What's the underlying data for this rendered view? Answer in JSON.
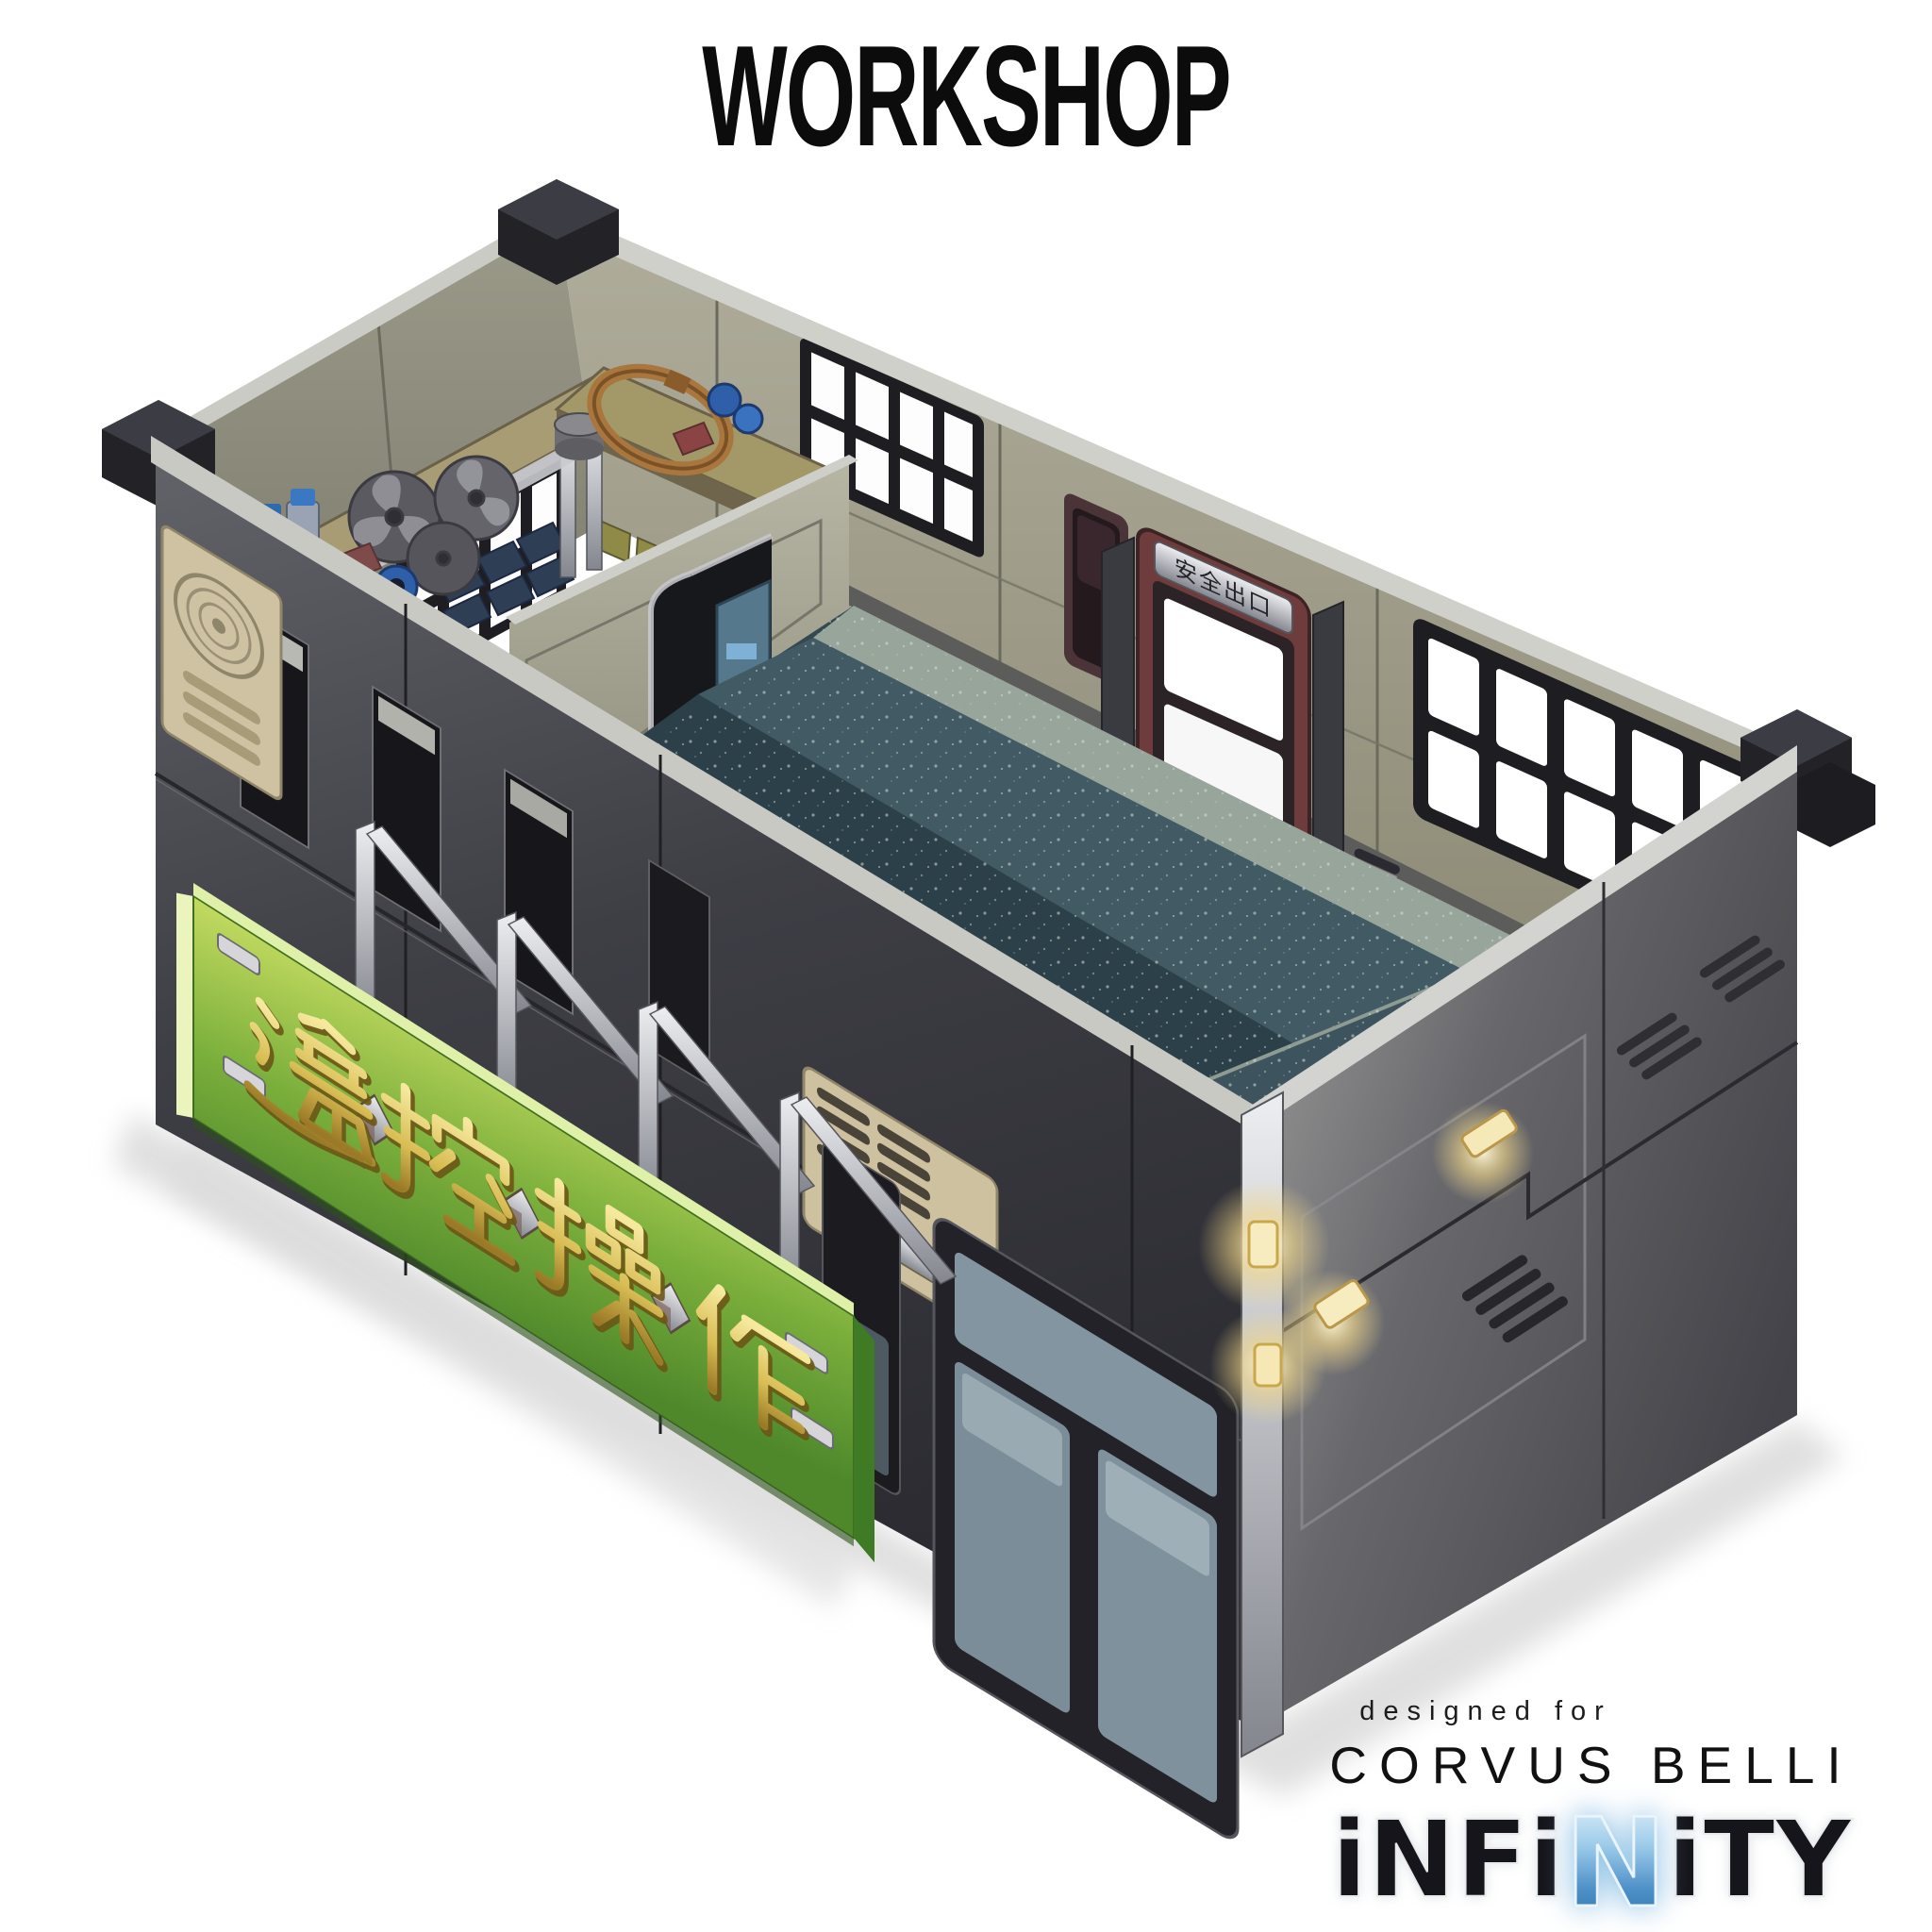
{
  "title": "WORKSHOP",
  "banner": {
    "text": "遥控操作",
    "characters": [
      "遥",
      "控",
      "操",
      "作"
    ],
    "panel_color": "#7fb23f",
    "character_color": "#d9bd55"
  },
  "building": {
    "exit_sign": "安全出口"
  },
  "footer": {
    "designed_for": "designed for",
    "brand": "CORVUS BELLI",
    "logo": {
      "part1": "iNFi",
      "accent": "N",
      "part2": "iTY"
    }
  },
  "colors": {
    "background": "#ffffff",
    "title_black": "#0c0c0c",
    "wall_dark": "#3b3b41",
    "wall_olive": "#8d8b7b",
    "floor_teal": "#3a525c",
    "sign_green": "#7fb23f",
    "gold": "#d9bd55",
    "glow_yellow": "#f3d98a",
    "infinity_blue": "#7db8e2"
  }
}
